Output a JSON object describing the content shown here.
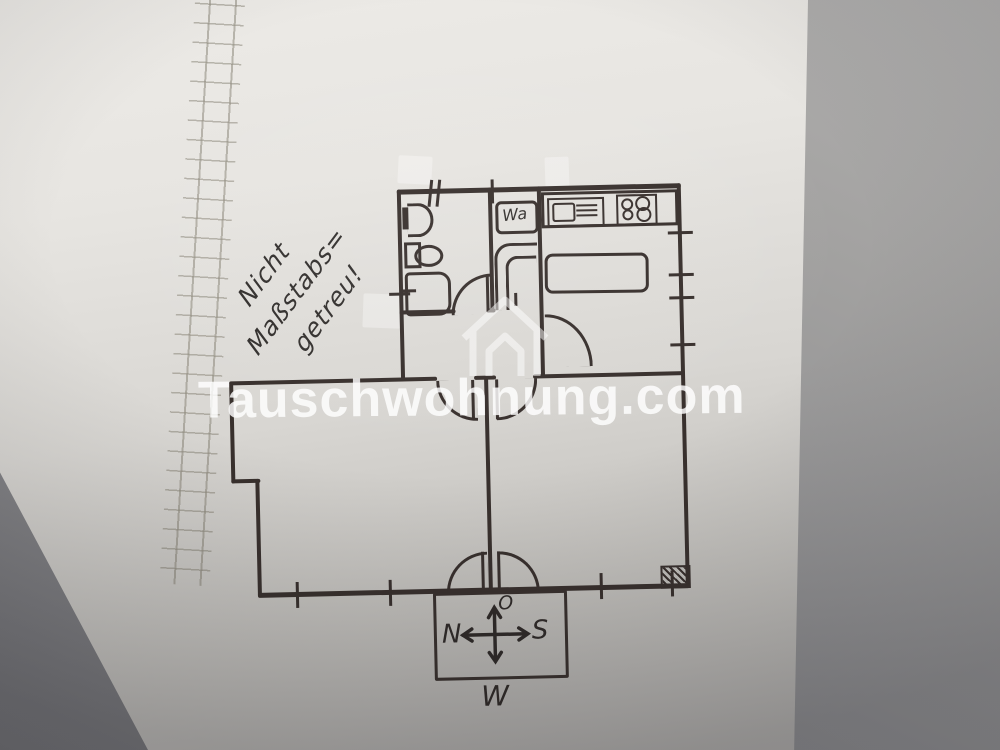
{
  "note": {
    "line1": "Nicht",
    "line2": "Maßstabs=",
    "line3": "getreu!"
  },
  "watermark": {
    "text": "Tauschwohnung.com"
  },
  "kitchen": {
    "washer_label": "Wa"
  },
  "compass": {
    "top": "O",
    "left": "N",
    "right": "S",
    "bottom": "W"
  },
  "colors": {
    "ink": "#38302d",
    "paper": "#e9e7e3",
    "background_gray": "#8a8a8d",
    "watermark": "#ffffff",
    "grid_line": "#7d7869"
  }
}
